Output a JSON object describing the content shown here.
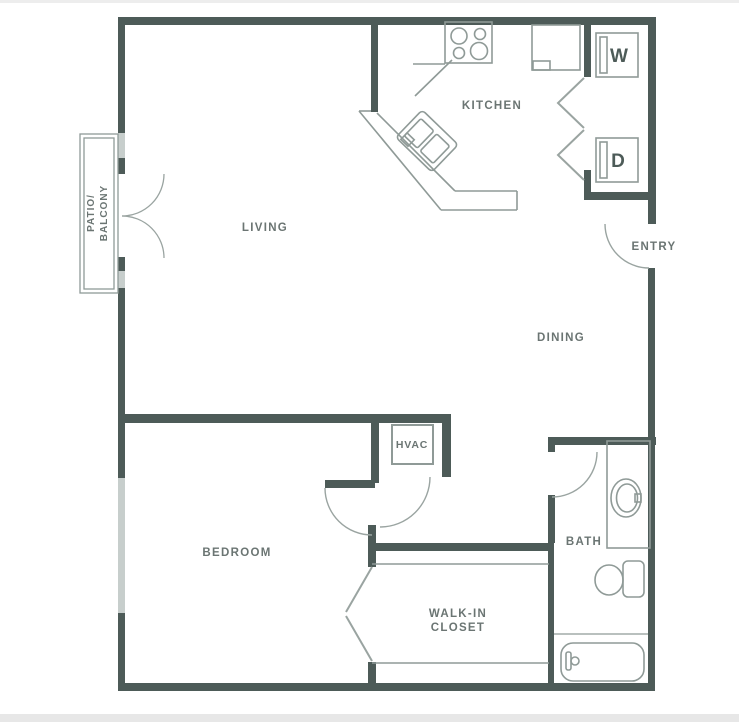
{
  "floor_plan": {
    "labels": {
      "living": "LIVING",
      "kitchen": "KITCHEN",
      "dining": "DINING",
      "entry": "ENTRY",
      "bedroom": "BEDROOM",
      "bath": "BATH",
      "hvac": "HVAC",
      "walk_in_closet_line1": "WALK-IN",
      "walk_in_closet_line2": "CLOSET",
      "patio_line1": "PATIO/",
      "patio_line2": "BALCONY",
      "washer": "W",
      "dryer": "D"
    },
    "colors": {
      "wall": "#4d5b58",
      "fixture_line": "#8f9a97",
      "window": "#c7cecc",
      "label_text": "#6b7573",
      "background": "#ffffff"
    }
  }
}
